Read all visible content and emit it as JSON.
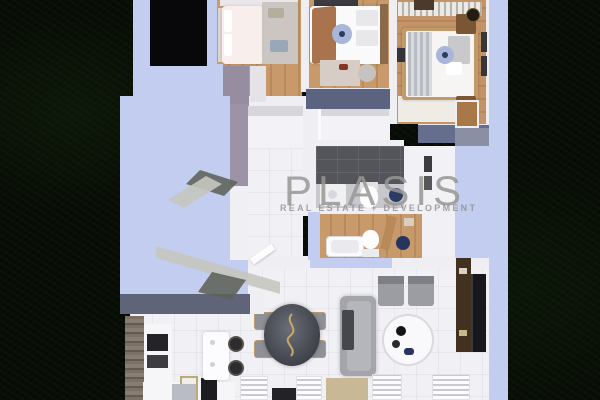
{
  "watermark": {
    "title": "PLASIS",
    "subtitle": "REAL ESTATE + DEVELOPMENT",
    "text_color": "#979893",
    "mark_light_color": "#c5c7c0",
    "mark_dark_color": "#5d6258"
  },
  "palette": {
    "grass_background": "#070b05",
    "exterior_wall_top": "#c3cdf0",
    "interior_wall": "#efeef3",
    "wall_cap": "#5f6478",
    "wardrobe_slate": "#5b6380",
    "interior_wall_mauve": "#9c93a7",
    "wood_floor": "#c8996a",
    "tile_floor": "#f1f0f4",
    "bathroom_dark_tile": "#54545b",
    "sofa_gray": "#a3a5aa",
    "accent_navy": "#27355e",
    "accent_brown_throw": "#a9744d",
    "tv_console_wood": "#43311f",
    "stair_void": "#08080a"
  },
  "scene": {
    "type": "top-down-3d-apartment-floor-plan",
    "rooms": [
      {
        "name": "bedroom-1",
        "furniture": [
          "double-bed-white-pink",
          "gray-rug",
          "white-wardrobe",
          "wall-shelf"
        ]
      },
      {
        "name": "bedroom-2",
        "furniture": [
          "double-bed-brown-throw",
          "ceiling-fan",
          "rug",
          "pouf",
          "slate-wardrobe",
          "headboard"
        ]
      },
      {
        "name": "bedroom-3",
        "furniture": [
          "double-bed-gray-blanket",
          "slat-feature-wall",
          "nightstand-top",
          "nightstand-bottom",
          "pendant-lamp",
          "wall-frames",
          "ceiling-fan",
          "rug",
          "closet-door",
          "slate-wardrobe"
        ]
      },
      {
        "name": "bathroom-1",
        "furniture": [
          "vanity",
          "toilet",
          "navy-stool",
          "dark-wall-tile"
        ]
      },
      {
        "name": "bathroom-2",
        "furniture": [
          "bathtub",
          "toilet",
          "wood-door-leaf",
          "navy-stool"
        ]
      },
      {
        "name": "hallway",
        "furniture": [
          "built-in-closet",
          "door-leaf"
        ]
      },
      {
        "name": "living-dining-kitchen",
        "furniture": [
          "gray-sofa",
          "two-armchairs",
          "round-coffee-table",
          "oval-dining-table",
          "four-gold-frame-chairs",
          "kitchen-island",
          "two-bar-stools",
          "tall-cabinet",
          "oven",
          "cooktop",
          "tv-console",
          "tv",
          "radiators",
          "doormat"
        ]
      }
    ],
    "exterior": [
      "dark-grass-lawn",
      "stairwell-void"
    ]
  }
}
